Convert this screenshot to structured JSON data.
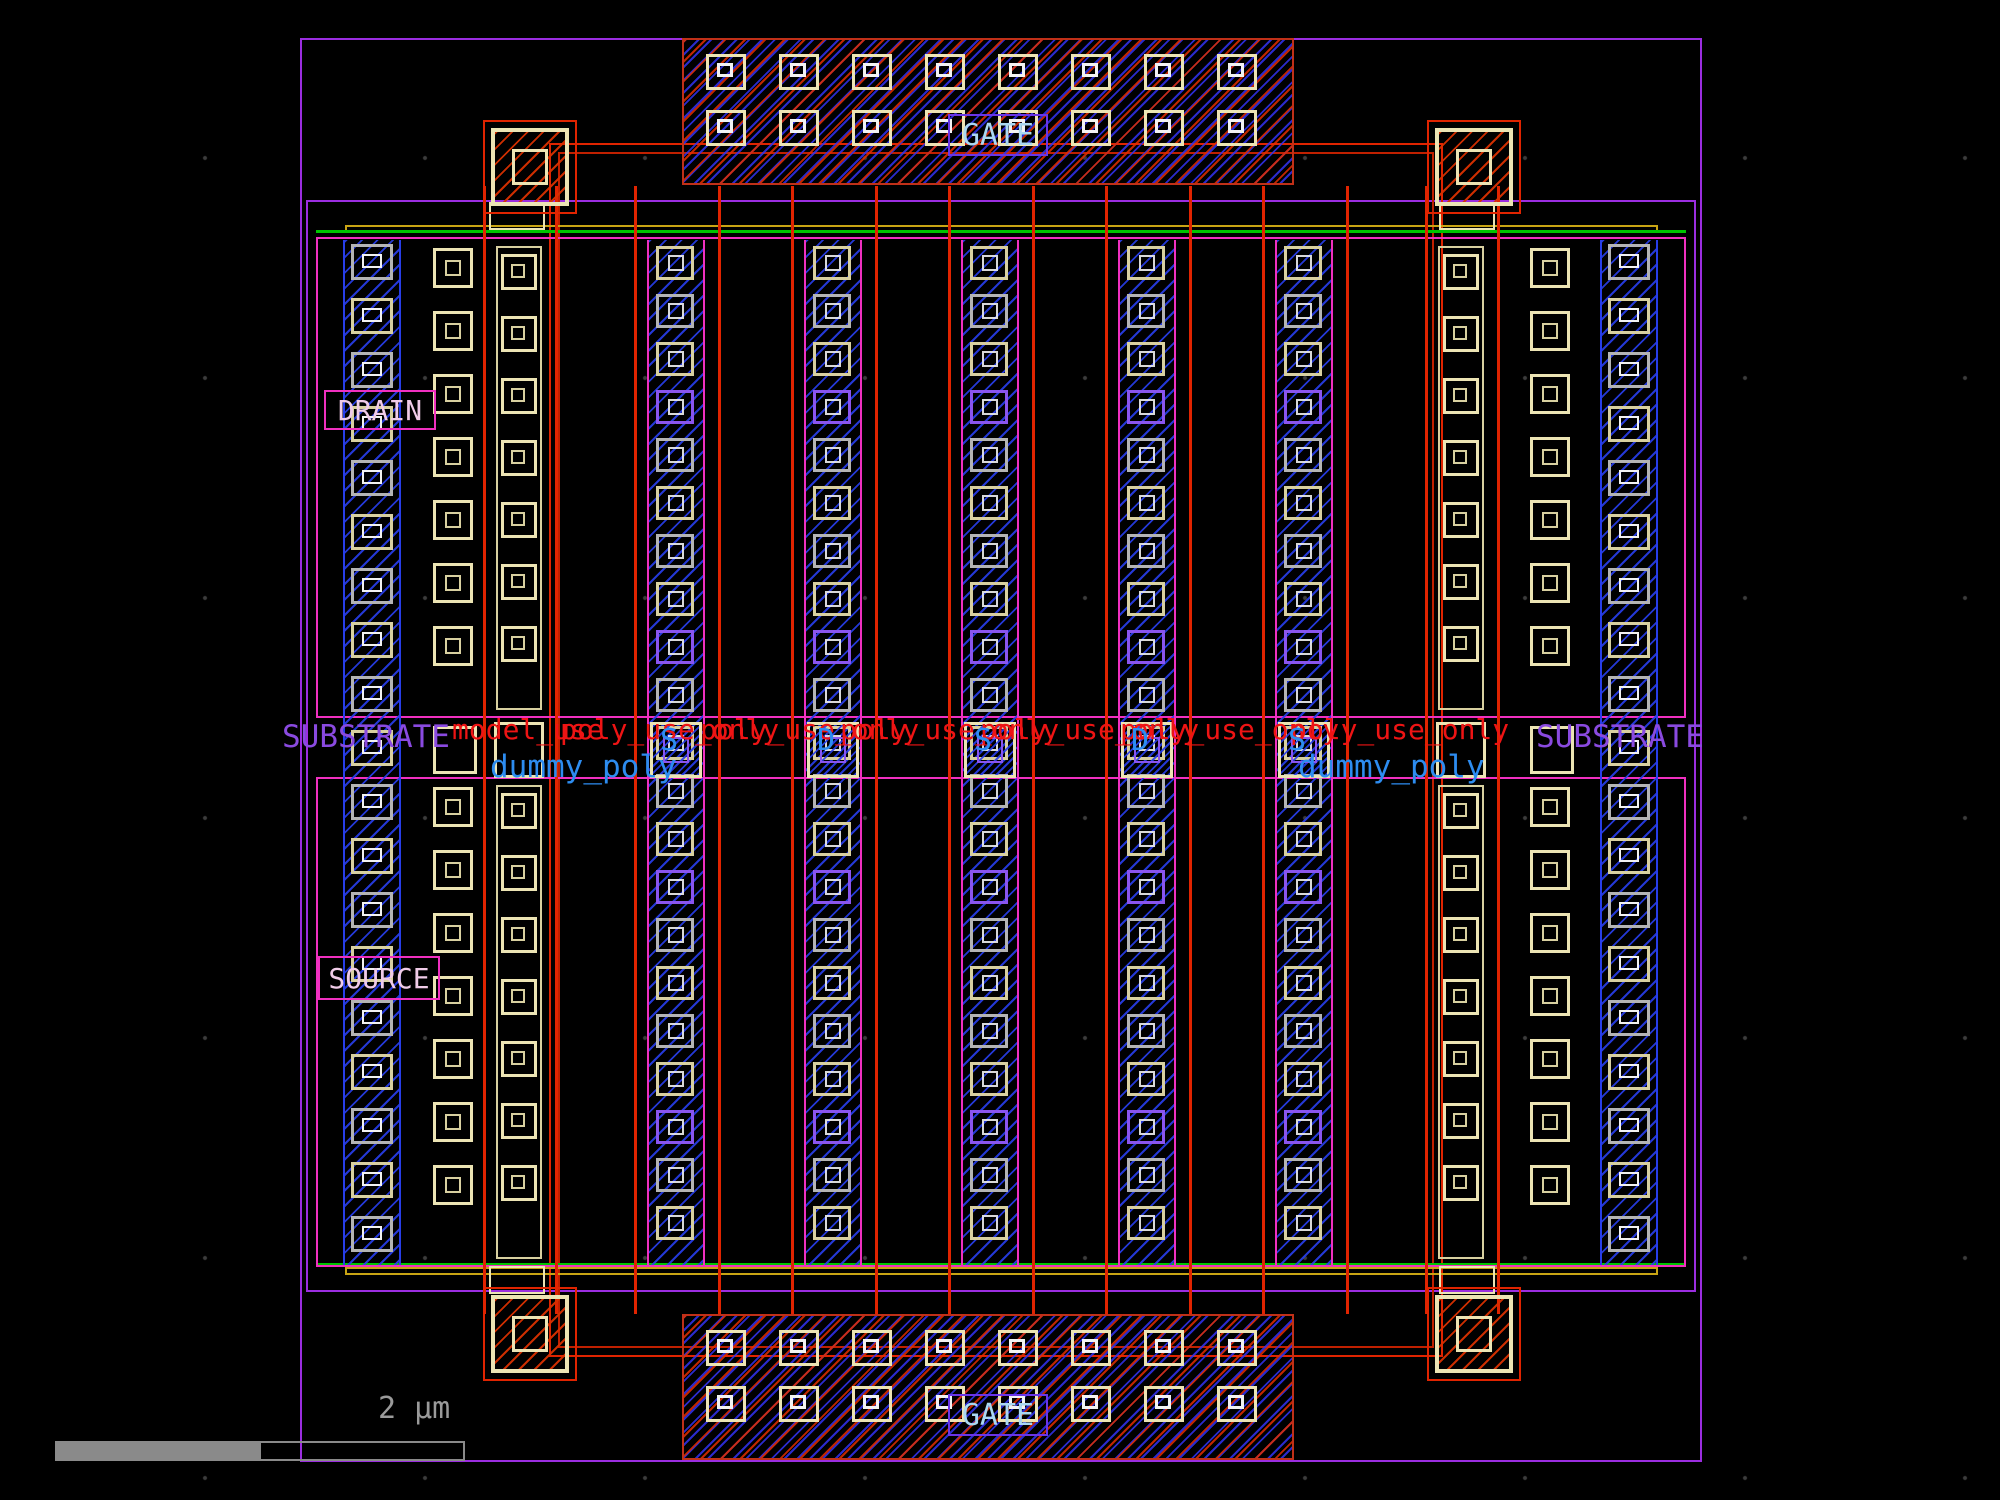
{
  "canvas": {
    "width": 2000,
    "height": 1500,
    "background": "#000000"
  },
  "colors": {
    "purple": "#9b2de0",
    "magenta": "#f030c0",
    "red": "#e02400",
    "red_dim": "#c02000",
    "blue_hatch": "#283ee8",
    "cream": "#ece4b4",
    "cream_dim": "#d8d0a0",
    "gray": "#b4b4b4",
    "white": "#f2f2f2",
    "green": "#00c400",
    "yellow": "#c8a414",
    "violet": "#6a35e8",
    "gate_text": "#a9d7f2",
    "substrate_text": "#8a4ae0",
    "dummy_text": "#2d8cf0",
    "red_text": "#ee1414",
    "pin_text": "#f0cbe8",
    "scale_gray": "#8a8a8a"
  },
  "labels": {
    "gate_top": "GATE",
    "gate_bottom": "GATE",
    "drain": "DRAIN",
    "source": "SOURCE",
    "substrate_left": "SUBSTRATE",
    "substrate_right": "SUBSTRATE",
    "dummy_poly_left": "dummy_poly",
    "dummy_poly_right": "dummy_poly",
    "scale_bar": "2 µm"
  },
  "net_labels": {
    "finger_letters": [
      "S",
      "D",
      "S",
      "D",
      "S"
    ],
    "red_text_row": [
      {
        "t": "model_use",
        "x": 452
      },
      {
        "t": "poly_use_only",
        "x": 560
      },
      {
        "t": "poly_use_only",
        "x": 700
      },
      {
        "t": "poly_use_only",
        "x": 840
      },
      {
        "t": "poly_use_only",
        "x": 980
      },
      {
        "t": "poly_use_only",
        "x": 1120
      },
      {
        "t": "poly_use_only",
        "x": 1290
      }
    ],
    "red_text_y": 716,
    "letters_y": 726
  },
  "layout_data": {
    "fingers": [
      {
        "center": 519,
        "type": "poly"
      },
      {
        "center": 676,
        "type": "metal",
        "letter_index": 0
      },
      {
        "center": 833,
        "type": "metal",
        "letter_index": 1
      },
      {
        "center": 990,
        "type": "metal",
        "letter_index": 2
      },
      {
        "center": 1147,
        "type": "metal",
        "letter_index": 3
      },
      {
        "center": 1304,
        "type": "metal",
        "letter_index": 4
      },
      {
        "center": 1461,
        "type": "poly"
      }
    ],
    "substrate_strips_x": [
      343,
      1600
    ],
    "contact_columns_x": [
      433,
      1530
    ],
    "device_span_y": [
      240,
      1265
    ],
    "halves_y": [
      [
        240,
        716
      ],
      [
        779,
        1265
      ]
    ],
    "gate_line_span_y": [
      186,
      1314
    ],
    "pad_top": {
      "x": 682,
      "y": 38,
      "w": 612,
      "h": 147
    },
    "pad_bottom": {
      "x": 682,
      "y": 1314,
      "w": 612,
      "h": 146
    },
    "pad_contact_rows": [
      14,
      70
    ],
    "pad_contact_cols": 8,
    "corner_contacts": [
      [
        491,
        128
      ],
      [
        1435,
        128
      ],
      [
        491,
        1295
      ],
      [
        1435,
        1295
      ]
    ],
    "corner_connectors": [
      [
        489,
        202
      ],
      [
        1439,
        202
      ],
      [
        489,
        1266
      ],
      [
        1439,
        1266
      ]
    ],
    "middle_row_y": 722
  }
}
